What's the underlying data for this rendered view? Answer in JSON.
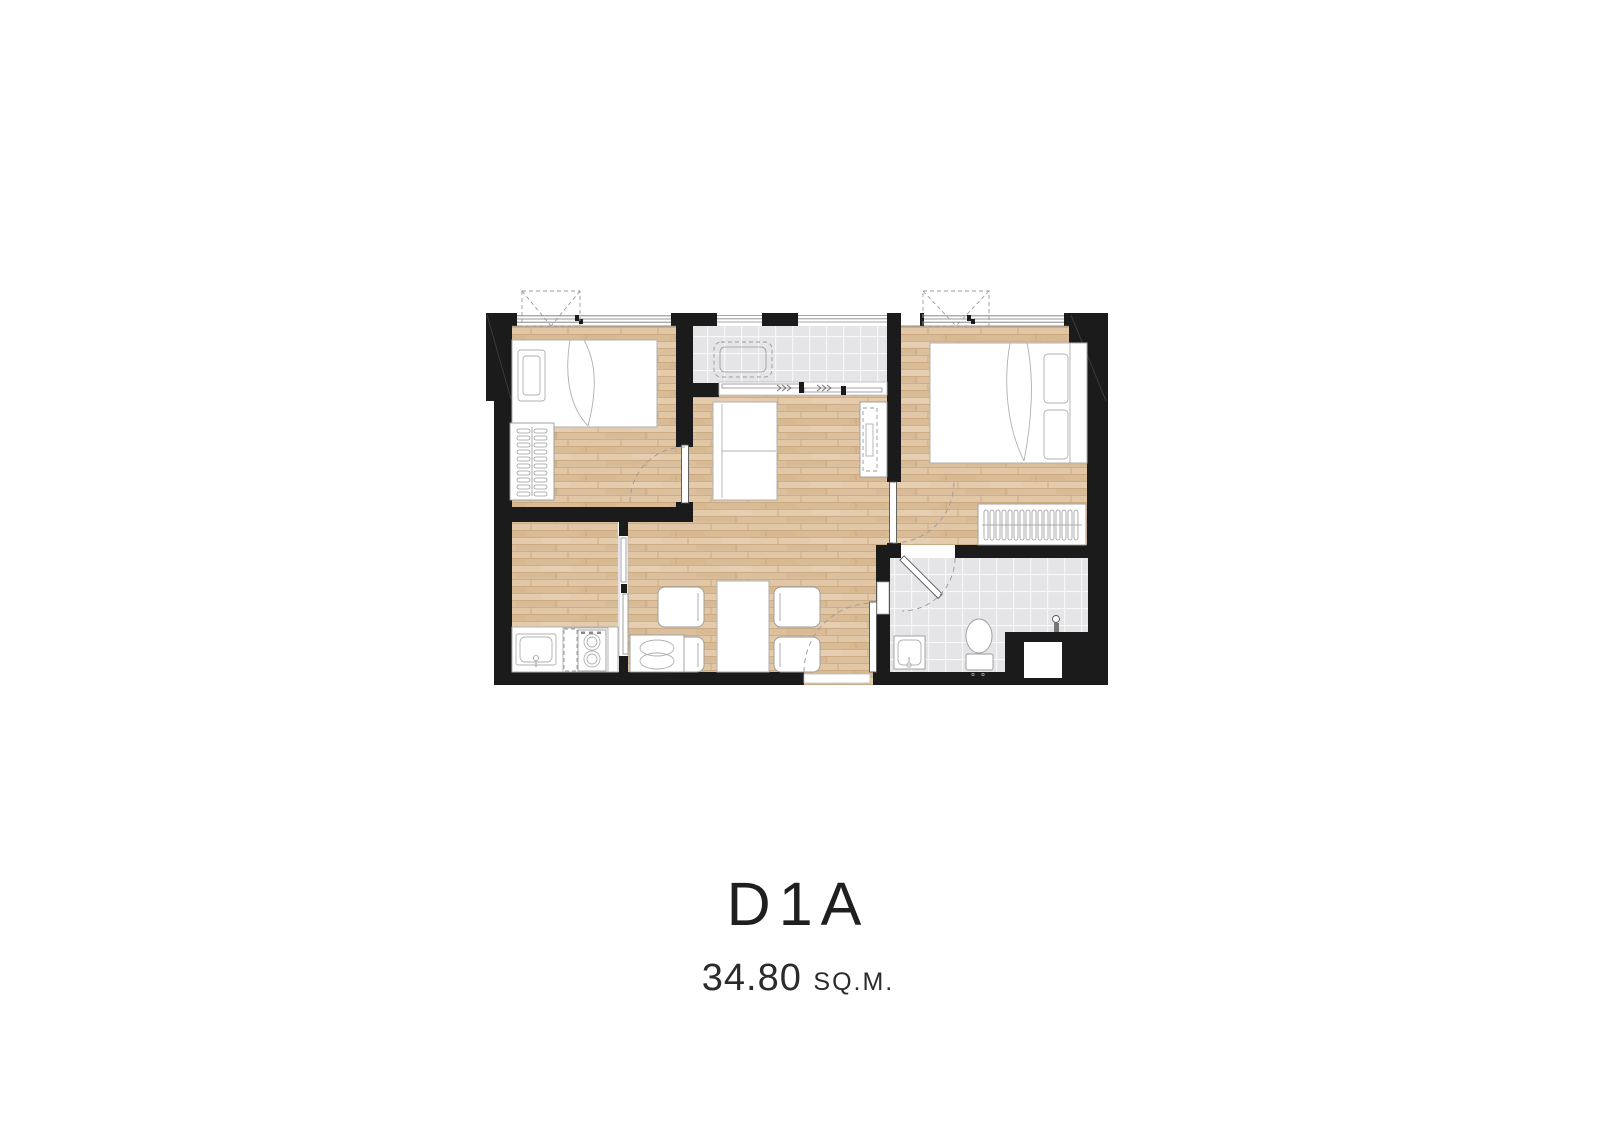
{
  "unit": {
    "name": "D1A",
    "area_value": "34.80",
    "area_unit": "SQ.M."
  },
  "plan": {
    "colors": {
      "wall": "#1b1b1b",
      "wood_floor": "#dfc5a3",
      "wood_line": "#c7a67c",
      "tile_floor": "#e5e5e8",
      "tile_line": "#f8f8fa",
      "furniture_stroke": "#b0b0b0",
      "door_arc": "#9a9a9a",
      "text": "#1f1f1f",
      "background": "#ffffff"
    },
    "rooms": [
      {
        "id": "bedroom-1",
        "furniture": [
          "single-bed",
          "pillow",
          "wardrobe-hangers",
          "hinged-door",
          "window",
          "ac-ledge"
        ]
      },
      {
        "id": "balcony",
        "furniture": [
          "ac-condenser-unit",
          "railing",
          "sliding-door"
        ]
      },
      {
        "id": "bedroom-2",
        "furniture": [
          "double-bed",
          "pillows",
          "wardrobe-hangers",
          "hinged-door",
          "window",
          "ac-ledge"
        ]
      },
      {
        "id": "living-dining",
        "furniture": [
          "sofa",
          "tv-console",
          "dining-table",
          "dining-chairs-x4",
          "low-cabinet",
          "entrance-door"
        ]
      },
      {
        "id": "kitchen",
        "furniture": [
          "counter",
          "sink",
          "two-burner-stove",
          "sliding-partition"
        ]
      },
      {
        "id": "bathroom",
        "furniture": [
          "wash-basin",
          "toilet",
          "shower-head",
          "hinged-door",
          "service-shaft"
        ]
      }
    ]
  }
}
